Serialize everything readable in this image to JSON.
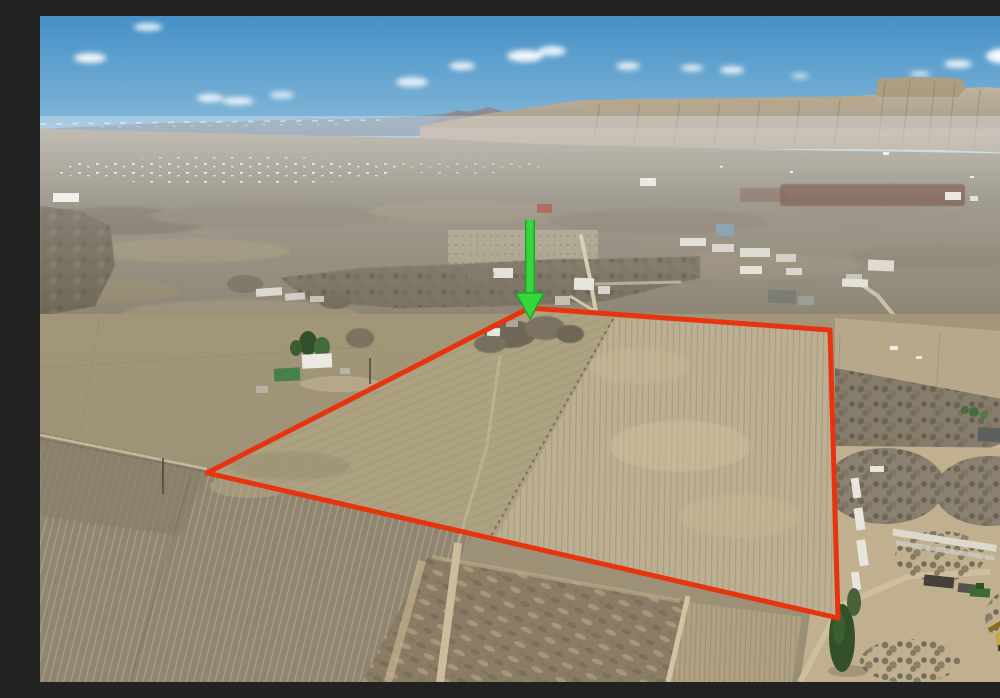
{
  "photo": {
    "type": "aerial-drone-photograph",
    "subject": "rural farmland parcel outlined in red with green locator arrow, desert cliffs on horizon",
    "width_px": 1000,
    "height_px": 666
  },
  "overlay": {
    "boundary": {
      "points": "167,457 489,292 790,314 798,602",
      "color": "#E8330F",
      "stroke_width": 5
    },
    "arrow": {
      "color": "#35D83B",
      "outline_color": "#1FA32C",
      "shaft": {
        "x1": 490,
        "y1": 204,
        "x2": 490,
        "y2": 280,
        "width": 7
      },
      "head_points": "476,277 504,277 490,303"
    }
  },
  "palette": {
    "sky_top": "#4590C7",
    "sky_horizon": "#BBD7E3",
    "distant_ridge": "#8096AA",
    "cliff_light": "#C3B7A3",
    "cliff_shadow": "#9C9182",
    "valley_haze": "#A09A8D",
    "scrub": "#8D8575",
    "field_tan": "#ACA181",
    "field_pale": "#BDB092",
    "field_brown": "#8F8571",
    "road": "#D3C7AB",
    "tree_gray": "#7A7161",
    "conifer_green": "#33502B",
    "red_soil": "#6E4A3B",
    "equipment_yellow": "#C9A33B"
  }
}
